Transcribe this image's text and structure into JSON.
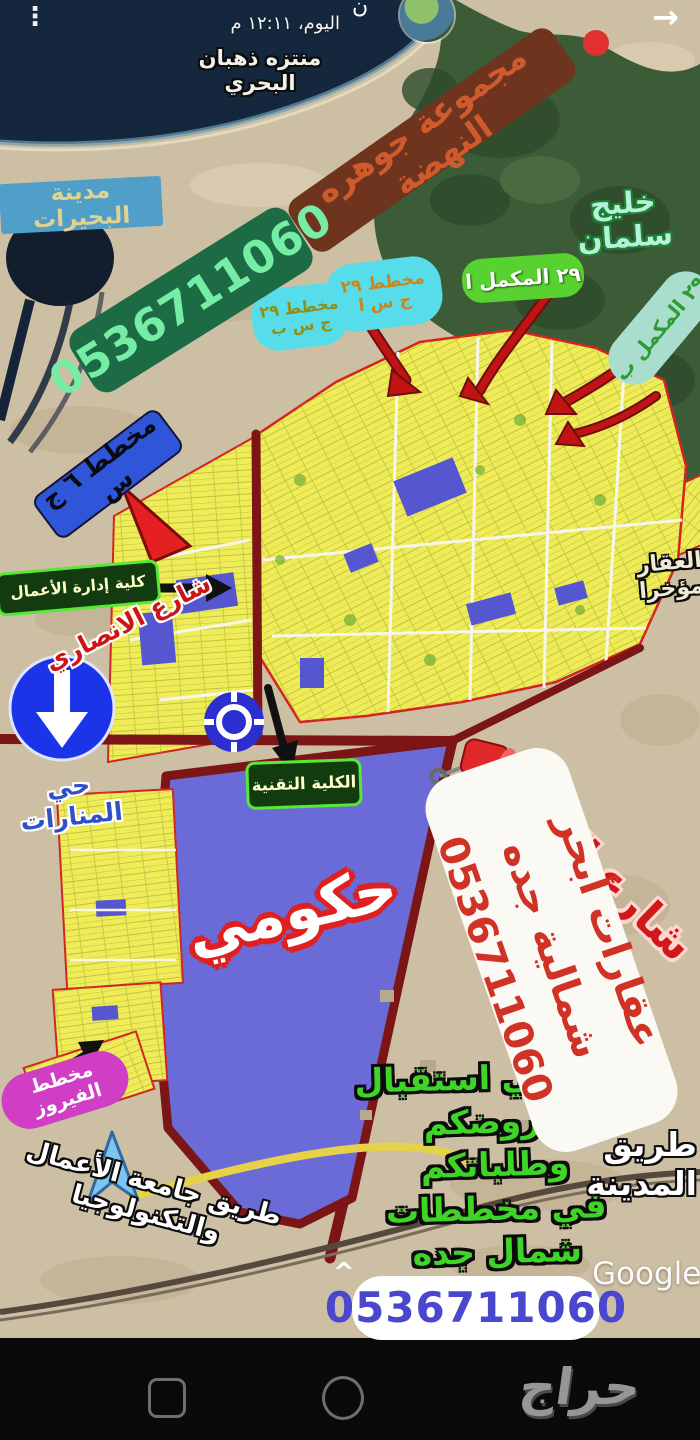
{
  "header": {
    "menu_icon": "kebab-menu",
    "subtitle": "اليوم، ١٢:١١ م",
    "title_fragment": "ن",
    "back_icon": "arrow-right"
  },
  "banners": {
    "group": {
      "text": "مجموعة جوهره النهضة",
      "bg": "#6f341d",
      "fg": "#cf5a2c"
    },
    "phone_top": {
      "text": "0536711060",
      "bg": "#1c6b45",
      "fg": "#76eda5"
    },
    "agency": {
      "text": "عقارات أبحر شمالية جده\n0536711060",
      "bg": "#fbf9f4",
      "fg": "#d03226"
    },
    "phone_bottom": {
      "text": "0536711060",
      "bg": "#ffffff",
      "fg": "#4a47cf"
    }
  },
  "map_labels": {
    "lakes_city": "مدينة البحيرات",
    "dhahban_park": "منتزه ذهبان\nالبحري",
    "salman_gulf": "خليج سلمان",
    "plan_29_a": "مخطط ٢٩\nج س ا",
    "plan_29_b": "مخطط ٢٩\nج س ب",
    "complement_29_a": "٢٩ المكمل ا",
    "complement_29_b": "٢٩ المكمل ب",
    "plan_6": "مخطط ٦ ج س",
    "business_college": "كلية إدارة الأعمال",
    "technical_college": "الكلية التقنية",
    "ansari_street": "شارع الانصاري",
    "hazm_street": "شارع الحزم",
    "manarat_district": "حي المنارات",
    "governmental": "حكومي",
    "fairuz_plan": "مخطط الفيروز",
    "madinah_road": "طريق المدينة",
    "ubt_road": "طريق جامعة الأعمال والتكنولوجيا",
    "right_edge_partial": "العقار\nمؤخرا"
  },
  "promo": {
    "text": "يسعدني استقبال\nعروضكم\nوطلباتكم\nفي مخططات\nشمال جده"
  },
  "watermarks": {
    "google": "Google",
    "haraj": "حراج"
  },
  "colors": {
    "plot_yellow": "#efec58",
    "government_blue": "#6b6bd8",
    "road_maroon": "#7c1616",
    "bubble_cyan": "#57dcea",
    "sea_dark": "#15273c",
    "mangrove_green": "#3c5c38"
  }
}
